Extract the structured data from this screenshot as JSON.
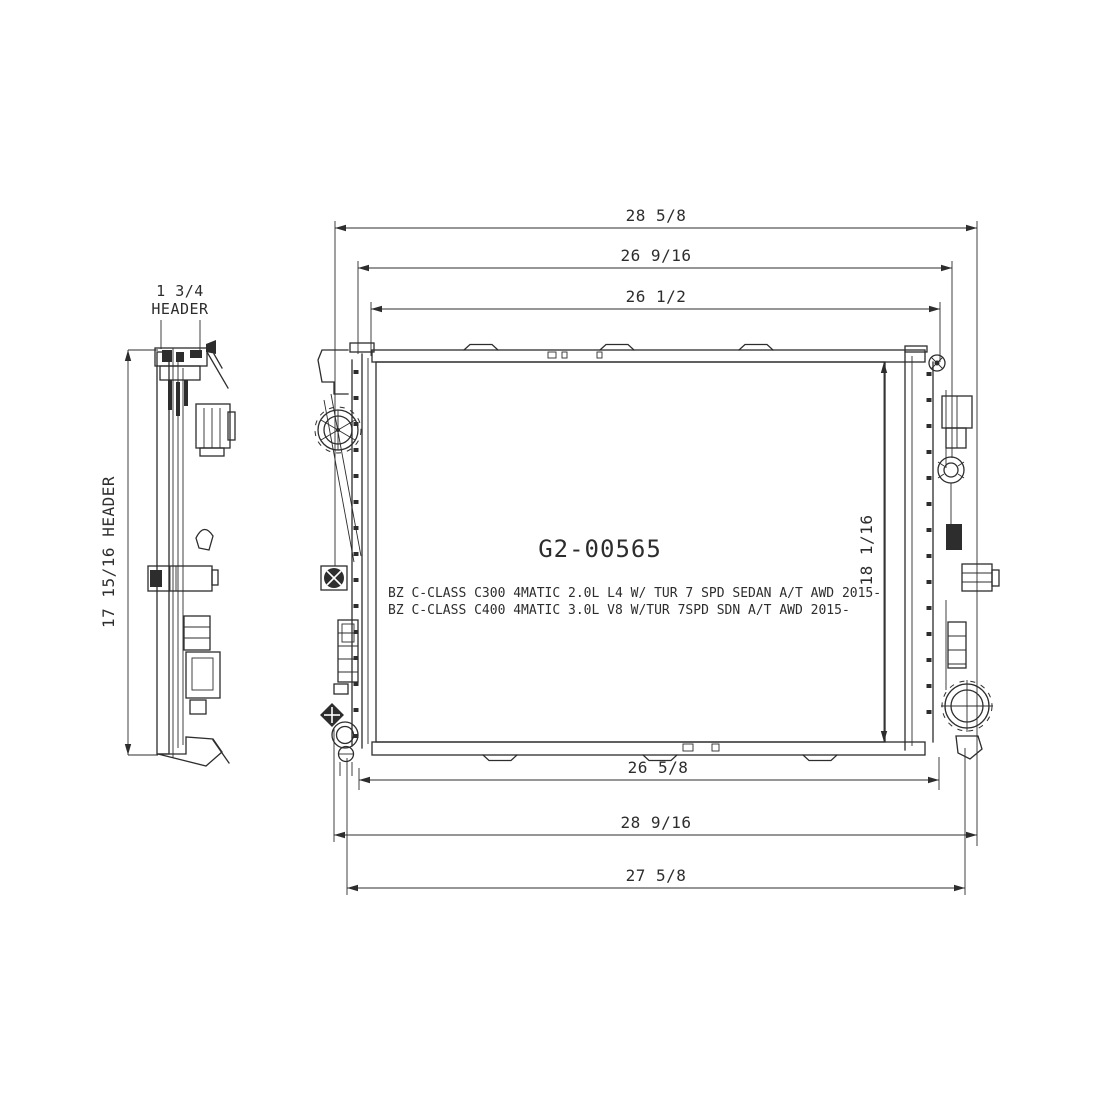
{
  "title": "Radiator Technical Drawing",
  "part_number": "G2-00565",
  "applications": [
    "BZ C-CLASS C300 4MATIC 2.0L L4 W/ TUR 7 SPD SEDAN A/T AWD 2015-",
    "BZ C-CLASS C400 4MATIC 3.0L V8 W/TUR 7SPD SDN A/T AWD 2015-"
  ],
  "dimensions": {
    "top": [
      "28 5/8",
      "26 9/16",
      "26 1/2"
    ],
    "bottom": [
      "26 5/8",
      "28 9/16",
      "27 5/8"
    ],
    "core_height": "18 1/16",
    "header_height": "17 15/16 HEADER",
    "header_thickness": "1 3/4",
    "header_thickness_label": "HEADER"
  },
  "colors": {
    "line": "#2d2d2d",
    "background": "#ffffff"
  }
}
